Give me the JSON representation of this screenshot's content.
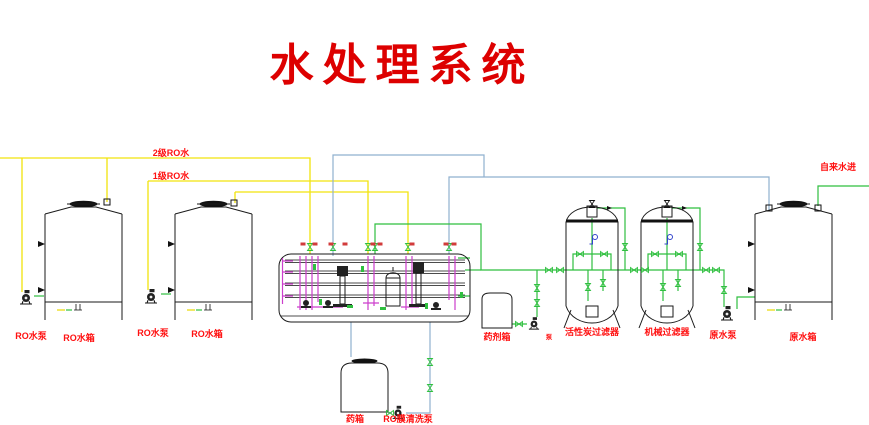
{
  "title": {
    "text": "水处理系统",
    "color": "#dd0000"
  },
  "pipe_labels": {
    "ro2": "2级RO水",
    "ro1": "1级RO水",
    "tap_water_in": "自来水进"
  },
  "equipment_labels": {
    "ro_pump_1": "RO水泵",
    "ro_tank_1": "RO水箱",
    "ro_pump_2": "RO水泵",
    "ro_tank_2": "RO水箱",
    "chem_tank": "药箱",
    "ro_membrane_cleaning_pump": "RO膜清洗泵",
    "dosing_tank": "药剂箱",
    "dosing_pump": "泵",
    "carbon_filter": "活性炭过滤器",
    "mechanical_filter": "机械过滤器",
    "raw_water_pump": "原水泵",
    "raw_water_tank": "原水箱"
  },
  "colors": {
    "label_red": "#ff1111",
    "title_red": "#dd0000",
    "pipe_yellow": "#f2e30c",
    "pipe_green": "#2fbf3f",
    "pipe_blue": "#8fb0cf",
    "pipe_magenta": "#cc3ecc",
    "line_black": "#1a1a1a"
  }
}
